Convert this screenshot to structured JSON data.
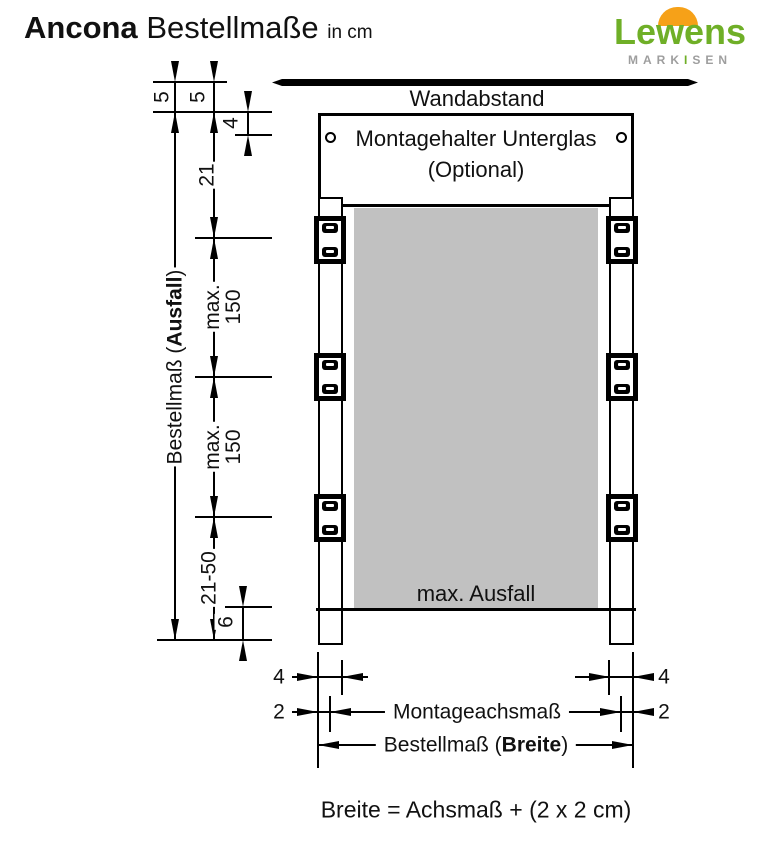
{
  "title": {
    "brand": "Ancona",
    "product": "Bestellmaße",
    "unit": "in cm"
  },
  "logo": {
    "wordmark": "Lewens",
    "tagline_left": "MARK",
    "tagline_i": "I",
    "tagline_right": "SEN",
    "green": "#6faf27",
    "orange": "#f6a118",
    "gray": "#9e9e9e"
  },
  "diagram": {
    "wall_label": "Wandabstand",
    "box": {
      "line1": "Montagehalter Unterglas",
      "line2": "(Optional)"
    },
    "fabric_label": "max. Ausfall",
    "fabric_color": "#c1c1c1",
    "dims": {
      "five_left": "5",
      "five_right": "5",
      "four_top": "4",
      "twenty_one": "21",
      "max_upper_l1": "max.",
      "max_upper_l2": "150",
      "max_lower_l1": "max.",
      "max_lower_l2": "150",
      "range": "21-50",
      "six": "6",
      "ausfall_prefix": "Bestellmaß (",
      "ausfall_bold": "Ausfall",
      "ausfall_suffix": ")",
      "four_bottom_left": "4",
      "two_bottom_left": "2",
      "four_bottom_right": "4",
      "two_bottom_right": "2",
      "axis_label": "Montageachsmaß",
      "breite_prefix": "Bestellmaß (",
      "breite_bold": "Breite",
      "breite_suffix": ")"
    },
    "formula": "Breite = Achsmaß + (2 x 2 cm)"
  }
}
